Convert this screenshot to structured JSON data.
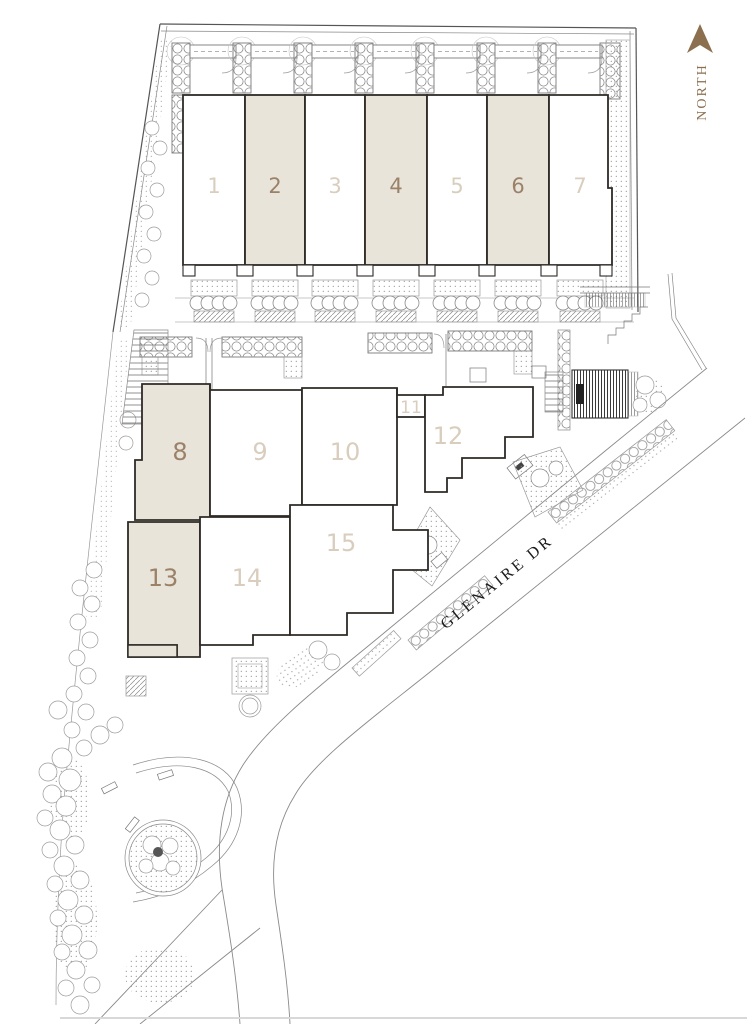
{
  "plan": {
    "north": {
      "label": "NORTH"
    },
    "street": {
      "label": "GLENAIRE DR"
    },
    "units": [
      {
        "id": "1",
        "label": "1",
        "shaded": false
      },
      {
        "id": "2",
        "label": "2",
        "shaded": true
      },
      {
        "id": "3",
        "label": "3",
        "shaded": false
      },
      {
        "id": "4",
        "label": "4",
        "shaded": true
      },
      {
        "id": "5",
        "label": "5",
        "shaded": false
      },
      {
        "id": "6",
        "label": "6",
        "shaded": true
      },
      {
        "id": "7",
        "label": "7",
        "shaded": false
      },
      {
        "id": "8",
        "label": "8",
        "shaded": true
      },
      {
        "id": "9",
        "label": "9",
        "shaded": false
      },
      {
        "id": "10",
        "label": "10",
        "shaded": false
      },
      {
        "id": "11",
        "label": "11",
        "shaded": false
      },
      {
        "id": "12",
        "label": "12",
        "shaded": false
      },
      {
        "id": "13",
        "label": "13",
        "shaded": true
      },
      {
        "id": "14",
        "label": "14",
        "shaded": false
      },
      {
        "id": "15",
        "label": "15",
        "shaded": false
      }
    ],
    "colors": {
      "unit_shaded_fill": "#e9e4da",
      "unit_unshaded_fill": "#ffffff",
      "unit_number_on_shaded": "#9a8167",
      "unit_number_on_white": "#d9cdbd",
      "north_arrow": "#8b6f4f",
      "street_text": "#1c1c1c",
      "building_outline": "#2e2a26",
      "landscape_line": "#9b9b9b"
    }
  }
}
